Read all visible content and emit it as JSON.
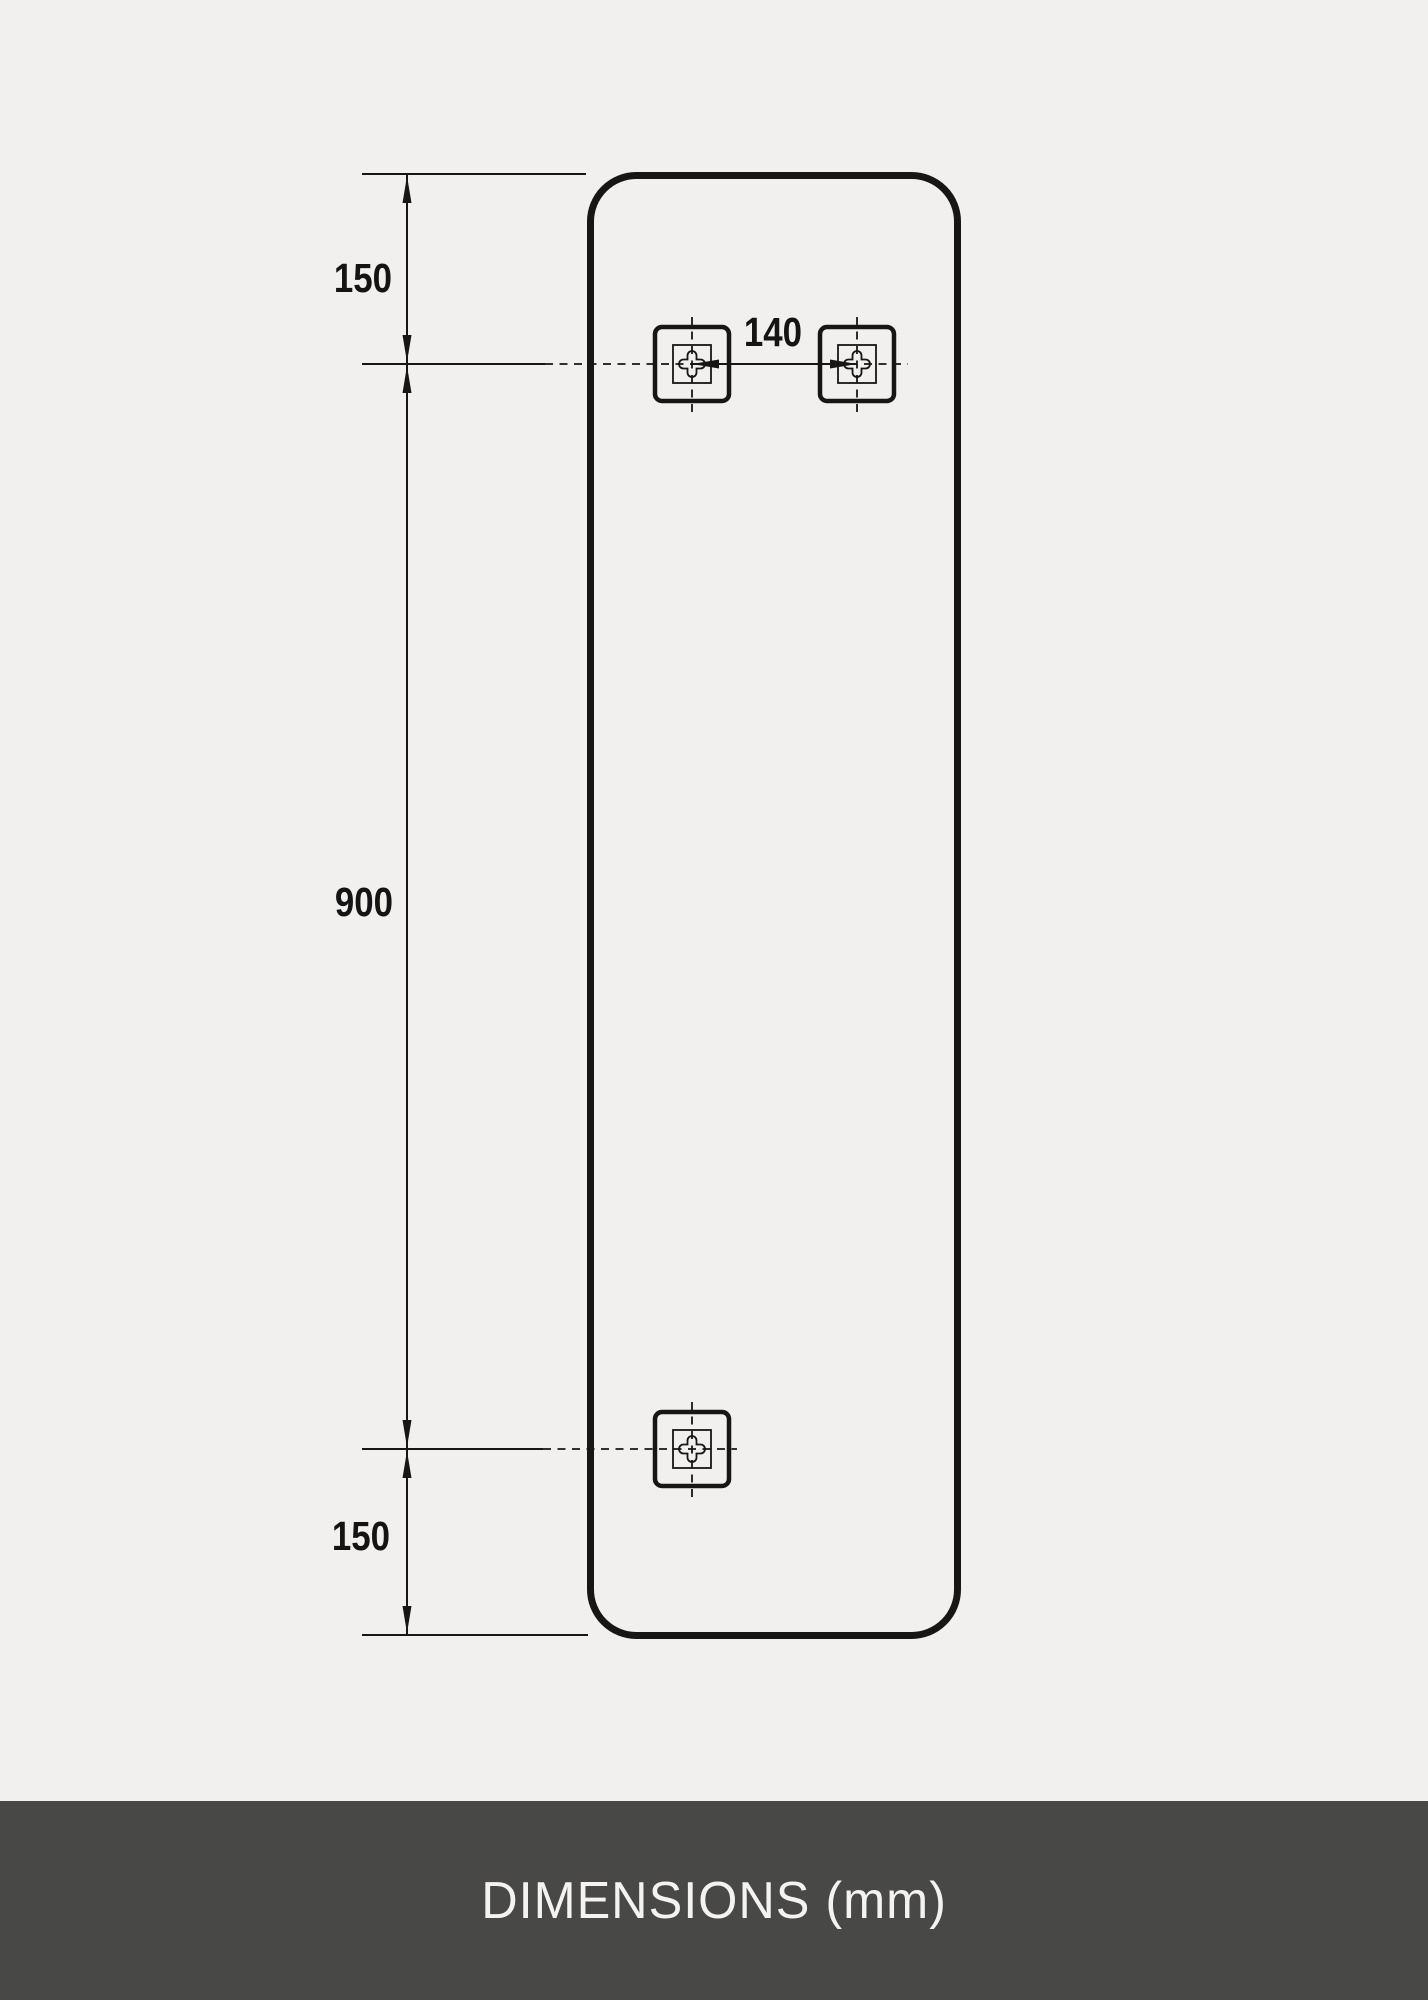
{
  "colors": {
    "background": "#f1f0ee",
    "line": "#161616",
    "footer_background": "#484847",
    "footer_text": "#f4f3f1"
  },
  "drawing": {
    "unit": "mm",
    "dimensions": {
      "top_offset": "150",
      "center_span": "900",
      "bottom_offset": "150",
      "keyhole_spacing": "140"
    }
  },
  "footer": {
    "title": "DIMENSIONS (mm)"
  }
}
